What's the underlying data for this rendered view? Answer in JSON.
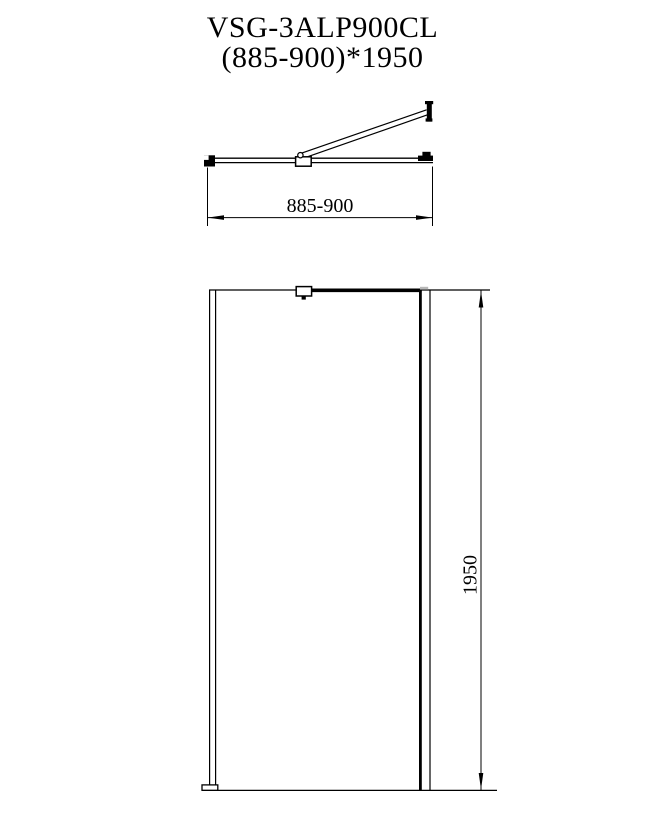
{
  "page": {
    "background_color": "#ffffff",
    "line_color": "#000000"
  },
  "title": {
    "model": "VSG-3ALP900CL",
    "size": "(885-900)*1950"
  },
  "top_view": {
    "width_dimension_label": "885-900"
  },
  "front_view": {
    "height_dimension_label": "1950"
  }
}
